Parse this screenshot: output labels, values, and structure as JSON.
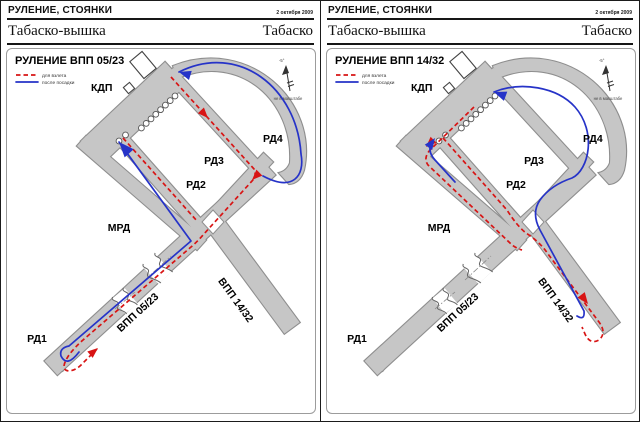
{
  "colors": {
    "takeoff_route": "#d81414",
    "landing_route": "#2633c8",
    "pavement": "#c6c6c6"
  },
  "panels": [
    {
      "section_title": "РУЛЕНИЕ, СТОЯНКИ",
      "date": "2 октября 2009",
      "station": "Табаско-вышка",
      "airport": "Табаско",
      "chart_title": "РУЛЕНИЕ ВПП 05/23",
      "legend": {
        "takeoff": "для взлета",
        "landing": "после посадки"
      },
      "north": {
        "declination": "-5°",
        "note": "не в масштабе"
      },
      "labels": {
        "kdp": "КДП",
        "rd1": "РД1",
        "rd2": "РД2",
        "rd3": "РД3",
        "rd4": "РД4",
        "mrd": "МРД",
        "rwy_0523": "ВПП 05/23",
        "rwy_1432": "ВПП 14/32"
      }
    },
    {
      "section_title": "РУЛЕНИЕ, СТОЯНКИ",
      "date": "2 октября 2009",
      "station": "Табаско-вышка",
      "airport": "Табаско",
      "chart_title": "РУЛЕНИЕ ВПП 14/32",
      "legend": {
        "takeoff": "для взлета",
        "landing": "после посадки"
      },
      "north": {
        "declination": "-5°",
        "note": "не в масштабе"
      },
      "labels": {
        "kdp": "КДП",
        "rd1": "РД1",
        "rd2": "РД2",
        "rd3": "РД3",
        "rd4": "РД4",
        "mrd": "МРД",
        "rwy_0523": "ВПП 05/23",
        "rwy_1432": "ВПП 14/32"
      }
    }
  ]
}
